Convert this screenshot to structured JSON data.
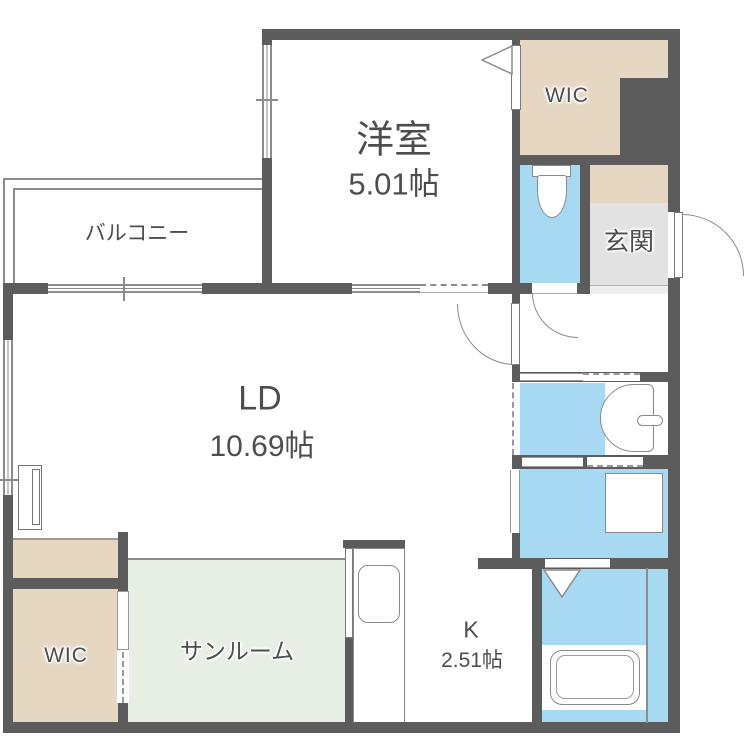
{
  "title": "apartment-floor-plan",
  "rooms": {
    "western_room": {
      "label": "洋室",
      "area": "5.01帖"
    },
    "balcony": {
      "label": "バルコニー"
    },
    "wic_upper": {
      "label": "WIC"
    },
    "entrance": {
      "label": "玄関"
    },
    "living_dining": {
      "label": "LD",
      "area": "10.69帖"
    },
    "wic_lower": {
      "label": "WIC"
    },
    "sunroom": {
      "label": "サンルーム"
    },
    "kitchen": {
      "label": "K",
      "area": "2.51帖"
    }
  },
  "fixtures": {
    "toilet": "toilet-icon",
    "vanity_sink": "sink-icon",
    "washing_machine_pan": "washer-pan-icon",
    "bathtub": "bathtub-icon",
    "kitchen_sink": "kitchen-sink-icon"
  },
  "colors": {
    "wall": "#5c5c5c",
    "closet": "#e6d7c3",
    "water_area": "#a8d9f2",
    "sunroom": "#e7efe5",
    "entrance_floor": "#e2e2e2",
    "entrance_step": "#efefef",
    "line": "#8c8c8c",
    "text": "#4d4d4d",
    "background": "#ffffff"
  }
}
